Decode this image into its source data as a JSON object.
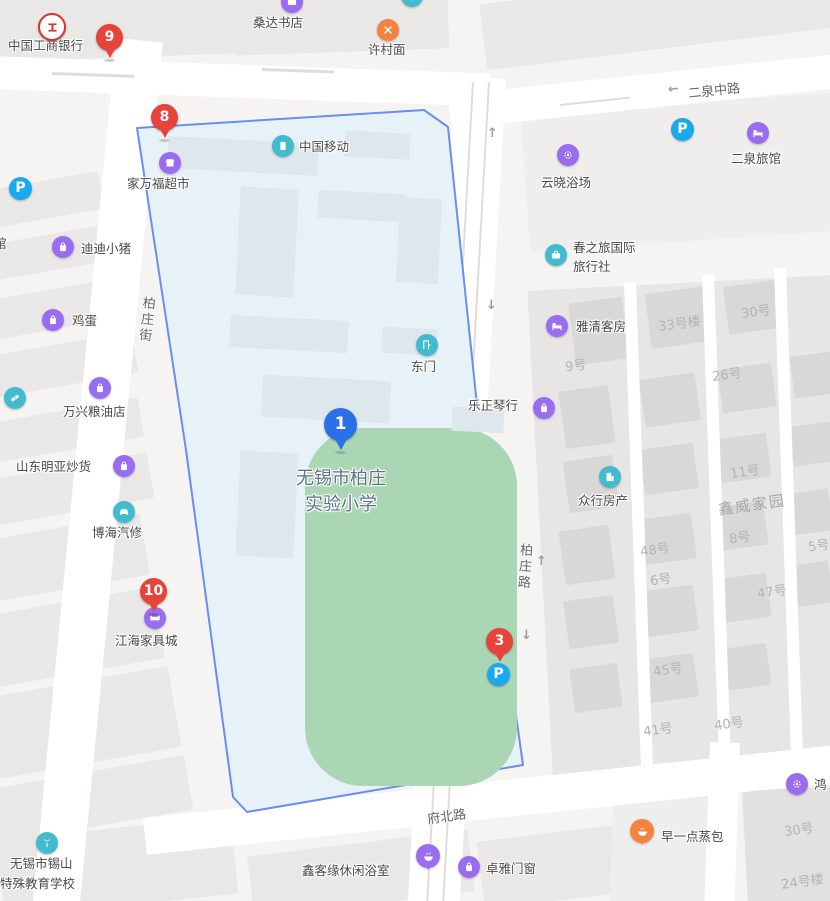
{
  "map_title": "无锡市柏庄实验小学周边地图",
  "labels": {
    "icbc": "中国工商银行",
    "sangda": "桑达书店",
    "xucun": "许村面",
    "road_erquan": "二泉中路",
    "yunxiao": "云晓浴场",
    "erquan_hotel": "二泉旅馆",
    "jiawanfu": "家万福超市",
    "china_mobile": "中国移动",
    "didi": "迪迪小猪",
    "guan_partial": "馆",
    "egg": "鸡蛋",
    "road_baizhuang_street": "柏庄街",
    "wanxing": "万兴粮油店",
    "shandong": "山东明亚炒货",
    "bohai": "博海汽修",
    "jianghai": "江海家具城",
    "school_line1": "无锡市柏庄",
    "school_line2": "实验小学",
    "east_gate": "东门",
    "lezheng": "乐正琴行",
    "chunzhilv_line1": "春之旅国际",
    "chunzhilv_line2": "旅行社",
    "yaqing": "雅清客房",
    "zhongxing": "众行房产",
    "xinwei": "鑫威家园",
    "road_baizhuang_road": "柏庄路",
    "road_fubei": "府北路",
    "xinkeyuan": "鑫客缘休闲浴室",
    "zhuoya": "卓雅门窗",
    "texiao_line1": "无锡市锡山",
    "texiao_line2": "特殊教育学校",
    "zaoyidian": "早一点蒸包",
    "hong_partial": "鸿",
    "no9": "9号",
    "no33lou": "33号楼",
    "no30": "30号",
    "no26": "26号",
    "no11": "11号",
    "no8": "8号",
    "no48": "48号",
    "no5": "5号",
    "no6": "6号",
    "no47": "47号",
    "no45": "45号",
    "no41": "41号",
    "no40": "40号",
    "no30b": "30号",
    "no24lou": "24号楼"
  },
  "markers": {
    "m1": "1",
    "m3": "3",
    "m8": "8",
    "m9": "9",
    "m10": "10"
  },
  "parking_label": "P",
  "arrows": {
    "up": "↑",
    "down": "↓",
    "left": "←"
  },
  "colors": {
    "school_fill": "#e6f2f7",
    "school_border": "#6b8df2",
    "field_green": "#abd6b5",
    "marker_red": "#e6443b",
    "marker_blue": "#2a70e8",
    "poi_purple": "#9a6cf0",
    "poi_teal": "#43bbce",
    "poi_orange": "#f5823f",
    "parking_blue": "#1aa9ec",
    "bank_red": "#d9342b",
    "building_gray": "#e7e6e4",
    "road_white": "#ffffff"
  }
}
